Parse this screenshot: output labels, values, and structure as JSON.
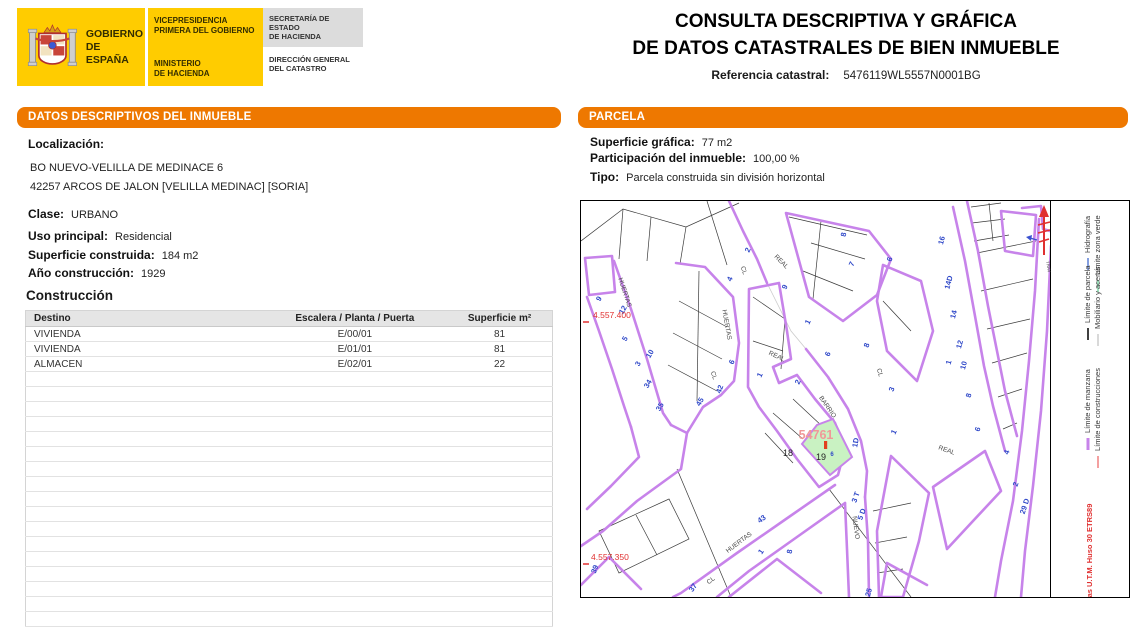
{
  "branding": {
    "gobierno_line1": "GOBIERNO",
    "gobierno_line2": "DE ESPAÑA",
    "vicepresidencia_line1": "VICEPRESIDENCIA",
    "vicepresidencia_line2": "PRIMERA DEL GOBIERNO",
    "ministerio_line1": "MINISTERIO",
    "ministerio_line2": "DE HACIENDA",
    "secretaria_line1": "SECRETARÍA DE ESTADO",
    "secretaria_line2": "DE HACIENDA",
    "direccion_line1": "DIRECCIÓN GENERAL",
    "direccion_line2": "DEL CATASTRO"
  },
  "header": {
    "title_line1": "CONSULTA DESCRIPTIVA Y GRÁFICA",
    "title_line2": "DE DATOS CATASTRALES DE BIEN INMUEBLE",
    "ref_label": "Referencia catastral:",
    "ref_value": "5476119WL5557N0001BG"
  },
  "inmueble": {
    "panel_title_part1": "DATOS DESCRIPTIVOS DEL ",
    "panel_title_part2": "INMUEBLE",
    "localizacion_label": "Localización:",
    "address_line1": "BO NUEVO-VELILLA DE MEDINACE 6",
    "address_line2": "42257 ARCOS DE JALON [VELILLA MEDINAC] [SORIA]",
    "clase_label": "Clase:",
    "clase_value": "URBANO",
    "uso_label": "Uso principal:",
    "uso_value": "Residencial",
    "superficie_label": "Superficie construida:",
    "superficie_value": "184 m2",
    "anio_label": "Año construcción:",
    "anio_value": "1929",
    "construccion_title": "Construcción",
    "table": {
      "headers": [
        "Destino",
        "Escalera / Planta / Puerta",
        "Superficie m²"
      ],
      "rows": [
        [
          "VIVIENDA",
          "E/00/01",
          "81"
        ],
        [
          "VIVIENDA",
          "E/01/01",
          "81"
        ],
        [
          "ALMACEN",
          "E/02/01",
          "22"
        ]
      ],
      "empty_rows": 17
    }
  },
  "parcela": {
    "panel_title": "PARCELA",
    "superficie_label": "Superficie gráfica:",
    "superficie_value": "77 m2",
    "participacion_label": "Participación del inmueble:",
    "participacion_value": "100,00 %",
    "tipo_label": "Tipo:",
    "tipo_value": "Parcela construida sin división horizontal",
    "map": {
      "number_color": "#2f48c8",
      "highlight_fill": "#c9f2c2",
      "manzana_color": "#c783ea",
      "labels": [
        {
          "t": "HUERTAS",
          "x": 42,
          "y": 92,
          "r": 72,
          "c": "#4a4a4a",
          "s": 6.5,
          "n": "street-label-huertas"
        },
        {
          "t": "HUERTAS",
          "x": 144,
          "y": 124,
          "r": 80,
          "c": "#4a4a4a",
          "s": 6.5,
          "n": "street-label-huertas"
        },
        {
          "t": "CL",
          "x": 131,
          "y": 175,
          "r": 70,
          "c": "#4a4a4a",
          "s": 6.5,
          "n": "street-label-cl"
        },
        {
          "t": "CL",
          "x": 161,
          "y": 70,
          "r": 70,
          "c": "#4a4a4a",
          "s": 6.5,
          "n": "street-label-cl"
        },
        {
          "t": "REAL",
          "x": 199,
          "y": 62,
          "r": 45,
          "c": "#4a4a4a",
          "s": 6.5,
          "n": "street-label-real"
        },
        {
          "t": "REAL",
          "x": 195,
          "y": 157,
          "r": 25,
          "c": "#4a4a4a",
          "s": 6.5,
          "n": "street-label-real"
        },
        {
          "t": "BARRIO",
          "x": 245,
          "y": 207,
          "r": 55,
          "c": "#4a4a4a",
          "s": 6.5,
          "n": "street-label-barrio"
        },
        {
          "t": "CL",
          "x": 297,
          "y": 172,
          "r": 75,
          "c": "#4a4a4a",
          "s": 6.5,
          "n": "street-label-cl"
        },
        {
          "t": "NUEVO",
          "x": 273,
          "y": 327,
          "r": 82,
          "c": "#4a4a4a",
          "s": 6.5,
          "n": "street-label-nuevo"
        },
        {
          "t": "REAL",
          "x": 365,
          "y": 251,
          "r": 20,
          "c": "#4a4a4a",
          "s": 6.5,
          "n": "street-label-real"
        },
        {
          "t": "HUERTAS",
          "x": 159,
          "y": 343,
          "r": -37,
          "c": "#4a4a4a",
          "s": 6.5,
          "n": "street-label-huertas"
        },
        {
          "t": "CL",
          "x": 131,
          "y": 381,
          "r": -37,
          "c": "#4a4a4a",
          "s": 6.5,
          "n": "street-label-cl"
        },
        {
          "t": "TRAV",
          "x": 466,
          "y": 66,
          "r": 80,
          "c": "#4a4a4a",
          "s": 4.5,
          "n": "street-label-trav"
        },
        {
          "t": "9",
          "x": 20,
          "y": 99,
          "r": -60,
          "b": 1
        },
        {
          "t": "12",
          "x": 44,
          "y": 110,
          "r": -60,
          "b": 1
        },
        {
          "t": "5",
          "x": 46,
          "y": 139,
          "r": -60,
          "b": 1
        },
        {
          "t": "3",
          "x": 59,
          "y": 164,
          "r": -60,
          "b": 1
        },
        {
          "t": "10",
          "x": 71,
          "y": 154,
          "r": -60,
          "b": 1
        },
        {
          "t": "34",
          "x": 69,
          "y": 184,
          "r": -60,
          "b": 1
        },
        {
          "t": "35",
          "x": 81,
          "y": 207,
          "r": -60,
          "b": 1
        },
        {
          "t": "45",
          "x": 121,
          "y": 202,
          "r": -60,
          "b": 1
        },
        {
          "t": "42",
          "x": 141,
          "y": 189,
          "r": -70,
          "b": 1
        },
        {
          "t": "2",
          "x": 169,
          "y": 50,
          "r": -65,
          "b": 1
        },
        {
          "t": "4",
          "x": 151,
          "y": 79,
          "r": -65,
          "b": 1
        },
        {
          "t": "9",
          "x": 206,
          "y": 87,
          "r": -65,
          "b": 1
        },
        {
          "t": "8",
          "x": 265,
          "y": 34,
          "r": -80,
          "b": 1
        },
        {
          "t": "7",
          "x": 273,
          "y": 64,
          "r": -65,
          "b": 1
        },
        {
          "t": "1",
          "x": 229,
          "y": 122,
          "r": -65,
          "b": 1
        },
        {
          "t": "6",
          "x": 249,
          "y": 154,
          "r": -65,
          "b": 1
        },
        {
          "t": "6",
          "x": 153,
          "y": 162,
          "r": -65,
          "b": 1
        },
        {
          "t": "1",
          "x": 181,
          "y": 175,
          "r": -65,
          "b": 1
        },
        {
          "t": "2",
          "x": 219,
          "y": 182,
          "r": -65,
          "b": 1
        },
        {
          "t": "6",
          "x": 311,
          "y": 59,
          "r": -70,
          "b": 1
        },
        {
          "t": "8",
          "x": 288,
          "y": 145,
          "r": -70,
          "b": 1
        },
        {
          "t": "3",
          "x": 313,
          "y": 189,
          "r": -70,
          "b": 1
        },
        {
          "t": "16",
          "x": 363,
          "y": 40,
          "r": -75,
          "b": 1
        },
        {
          "t": "14D",
          "x": 370,
          "y": 82,
          "r": -75,
          "b": 1
        },
        {
          "t": "14",
          "x": 375,
          "y": 114,
          "r": -75,
          "b": 1
        },
        {
          "t": "12",
          "x": 381,
          "y": 144,
          "r": -75,
          "b": 1
        },
        {
          "t": "1",
          "x": 370,
          "y": 162,
          "r": -75,
          "b": 1
        },
        {
          "t": "10",
          "x": 385,
          "y": 165,
          "r": -75,
          "b": 1
        },
        {
          "t": "8",
          "x": 390,
          "y": 195,
          "r": -75,
          "b": 1
        },
        {
          "t": "6",
          "x": 399,
          "y": 229,
          "r": -70,
          "b": 1
        },
        {
          "t": "4",
          "x": 428,
          "y": 252,
          "r": -70,
          "b": 1
        },
        {
          "t": "2",
          "x": 437,
          "y": 284,
          "r": -70,
          "b": 1
        },
        {
          "t": "29 D",
          "x": 446,
          "y": 306,
          "r": -72,
          "b": 1
        },
        {
          "t": "1D",
          "x": 277,
          "y": 242,
          "r": -80,
          "b": 1
        },
        {
          "t": "3 T",
          "x": 277,
          "y": 297,
          "r": -70,
          "b": 1
        },
        {
          "t": "5 D",
          "x": 283,
          "y": 314,
          "r": -70,
          "b": 1
        },
        {
          "t": "1",
          "x": 315,
          "y": 232,
          "r": -65,
          "b": 1
        },
        {
          "t": "43",
          "x": 182,
          "y": 320,
          "r": -35,
          "b": 1
        },
        {
          "t": "1",
          "x": 182,
          "y": 352,
          "r": -55,
          "b": 1
        },
        {
          "t": "8",
          "x": 211,
          "y": 351,
          "r": -80,
          "b": 1
        },
        {
          "t": "37",
          "x": 114,
          "y": 388,
          "r": -55,
          "b": 1
        },
        {
          "t": "39",
          "x": 16,
          "y": 369,
          "r": -70,
          "b": 1
        },
        {
          "t": "25",
          "x": 290,
          "y": 392,
          "r": -75,
          "b": 1
        },
        {
          "t": "6",
          "x": 251,
          "y": 255,
          "s": 6,
          "b": 1
        },
        {
          "t": "18",
          "x": 207,
          "y": 255,
          "s": 9,
          "c": "#222222",
          "n": "parcel-number"
        },
        {
          "t": "19",
          "x": 240,
          "y": 259,
          "s": 9,
          "c": "#222222",
          "n": "parcel-number"
        },
        {
          "t": "54761",
          "x": 235,
          "y": 238,
          "s": 12.5,
          "c": "#f09898",
          "b": 1,
          "n": "highlighted-parcel-label"
        },
        {
          "t": "4.557.400",
          "x": 12,
          "y": 117,
          "c": "#e03030",
          "s": 8.5,
          "a": "s",
          "n": "utm-coordinate"
        },
        {
          "t": "4.557.350",
          "x": 10,
          "y": 359,
          "c": "#e03030",
          "s": 8.5,
          "a": "s",
          "n": "utm-coordinate"
        },
        {
          "t": "Hidrografía",
          "x": 509,
          "y": 52,
          "r": -90,
          "a": "s",
          "c": "#3a3a3a",
          "s": 7.5,
          "sw": "#5a7fd6",
          "n": "legend-hidrografia"
        },
        {
          "t": "Límite zona verde",
          "x": 519,
          "y": 74,
          "r": -90,
          "a": "s",
          "c": "#3a3a3a",
          "s": 7.5,
          "sw": "#7fd9a9",
          "n": "legend-zona-verde"
        },
        {
          "t": "Límite de parcela",
          "x": 509,
          "y": 122,
          "r": -90,
          "a": "s",
          "c": "#3a3a3a",
          "s": 7.5,
          "sw": "#000000",
          "n": "legend-parcela"
        },
        {
          "t": "Mobiliario y aceras",
          "x": 519,
          "y": 128,
          "r": -90,
          "a": "s",
          "c": "#3a3a3a",
          "s": 7.5,
          "sw": "#cccccc",
          "n": "legend-mobiliario"
        },
        {
          "t": "Límite de manzana",
          "x": 509,
          "y": 232,
          "r": -90,
          "a": "s",
          "c": "#3a3a3a",
          "s": 7.5,
          "sw": "#c783ea",
          "swW": 3,
          "n": "legend-manzana"
        },
        {
          "t": "Límite de construcciones",
          "x": 519,
          "y": 250,
          "r": -90,
          "a": "s",
          "c": "#3a3a3a",
          "s": 7.5,
          "sw": "#f08080",
          "n": "legend-construcciones"
        },
        {
          "t": "Coordenadas U.T.M. Huso 30 ETRS89",
          "x": 511,
          "y": 436,
          "r": -90,
          "a": "s",
          "c": "#e03030",
          "s": 7.5,
          "b": 1,
          "n": "crs-label"
        }
      ]
    }
  }
}
